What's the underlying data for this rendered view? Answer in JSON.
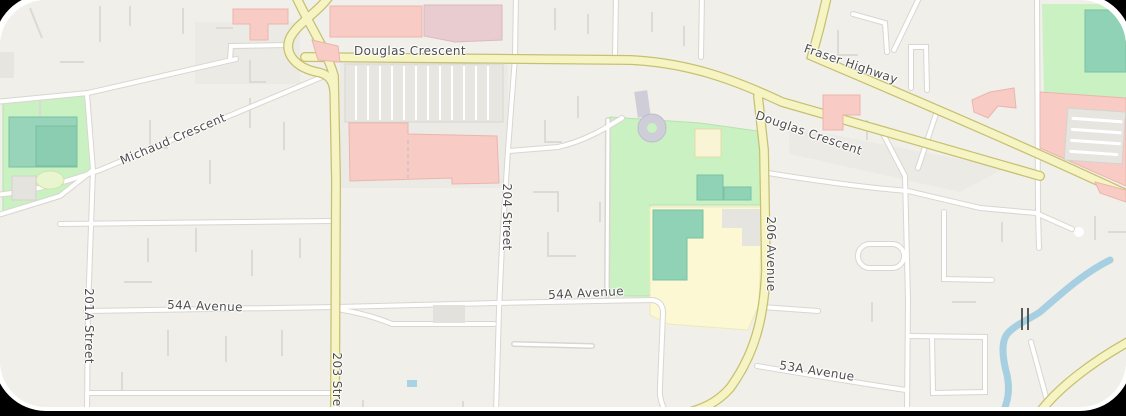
{
  "map": {
    "description": "Street map view (Langley area) with highways, residential grid, parks, school grounds, mall and stream",
    "interaction_hint": "draggable map canvas",
    "colors": {
      "land": "#f1efe9",
      "highway_fill": "#f7f4c3",
      "highway_casing": "#c6c072",
      "road_fill": "#ffffff",
      "road_casing": "#d9d6d0",
      "driveway": "#dcdad4",
      "park": "#c9f1c1",
      "field": "#fbf8d3",
      "water": "#a6d0e2",
      "building_commercial": "#f8cbc5",
      "building_commercial_alt": "#e9ccd0",
      "building_school": "#8fd2b6",
      "building_cream": "#faf4d6",
      "parking": "#e8e6e1",
      "keyhole_driveway": "#cfcdd8",
      "label_text": "#4e4e4e"
    },
    "road_labels": [
      {
        "id": "michaud-crescent",
        "text": "Michaud Crescent",
        "orientation": "diagonal"
      },
      {
        "id": "douglas-crescent-west",
        "text": "Douglas Crescent",
        "orientation": "horizontal"
      },
      {
        "id": "fraser-highway",
        "text": "Fraser Highway",
        "orientation": "diagonal"
      },
      {
        "id": "douglas-crescent-east",
        "text": "Douglas Crescent",
        "orientation": "diagonal"
      },
      {
        "id": "street-204",
        "text": "204 Street",
        "orientation": "vertical"
      },
      {
        "id": "avenue-206",
        "text": "206 Avenue",
        "orientation": "vertical"
      },
      {
        "id": "street-201a",
        "text": "201A Street",
        "orientation": "vertical"
      },
      {
        "id": "street-203",
        "text": "203 Street",
        "orientation": "vertical"
      },
      {
        "id": "avenue-54a-west",
        "text": "54A Avenue",
        "orientation": "horizontal"
      },
      {
        "id": "avenue-54a-east",
        "text": "54A Avenue",
        "orientation": "horizontal"
      },
      {
        "id": "avenue-53a",
        "text": "53A Avenue",
        "orientation": "horizontal"
      }
    ],
    "features": {
      "parks": [
        "west-park-school-grounds",
        "central-park-school-grounds",
        "northeast-park"
      ],
      "water": [
        "stream-southeast-with-bridge"
      ],
      "buildings": [
        "shopping-mall",
        "school-buildings",
        "commercial-pink-buildings"
      ],
      "parking_lots": [
        "mall-parking-lot",
        "northeast-parking-lot",
        "west-park-parking"
      ]
    }
  }
}
